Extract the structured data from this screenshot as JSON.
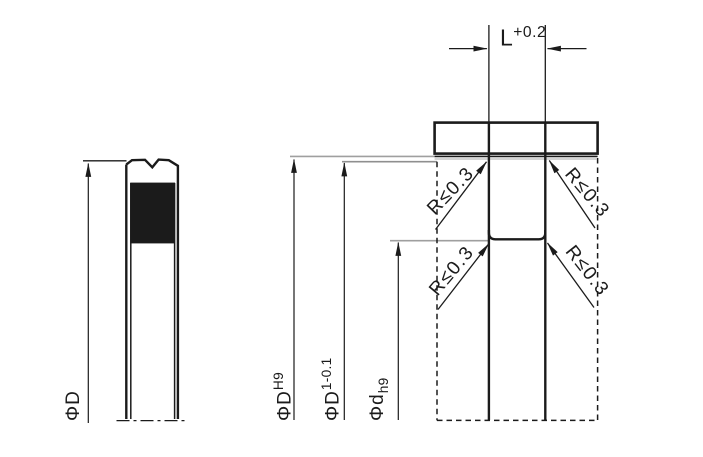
{
  "drawing": {
    "type": "seal-and-groove-installation-drawing",
    "background": "#ffffff",
    "line_color": "#1b1b1b",
    "seal_view": {
      "outer_diameter_label": {
        "base": "ΦD"
      }
    },
    "groove_view": {
      "groove_width_label": {
        "base": "L",
        "tolerance": "+0.2"
      },
      "bore_diameter_label": {
        "base": "ΦD",
        "tolerance": "H9"
      },
      "seal_seat_diameter_label": {
        "base": "ΦD",
        "tolerance": "1-0.1"
      },
      "groove_root_diameter_label": {
        "base": "Φd",
        "tolerance": "h9"
      },
      "corner_radius_note": "R≤0.3"
    }
  }
}
